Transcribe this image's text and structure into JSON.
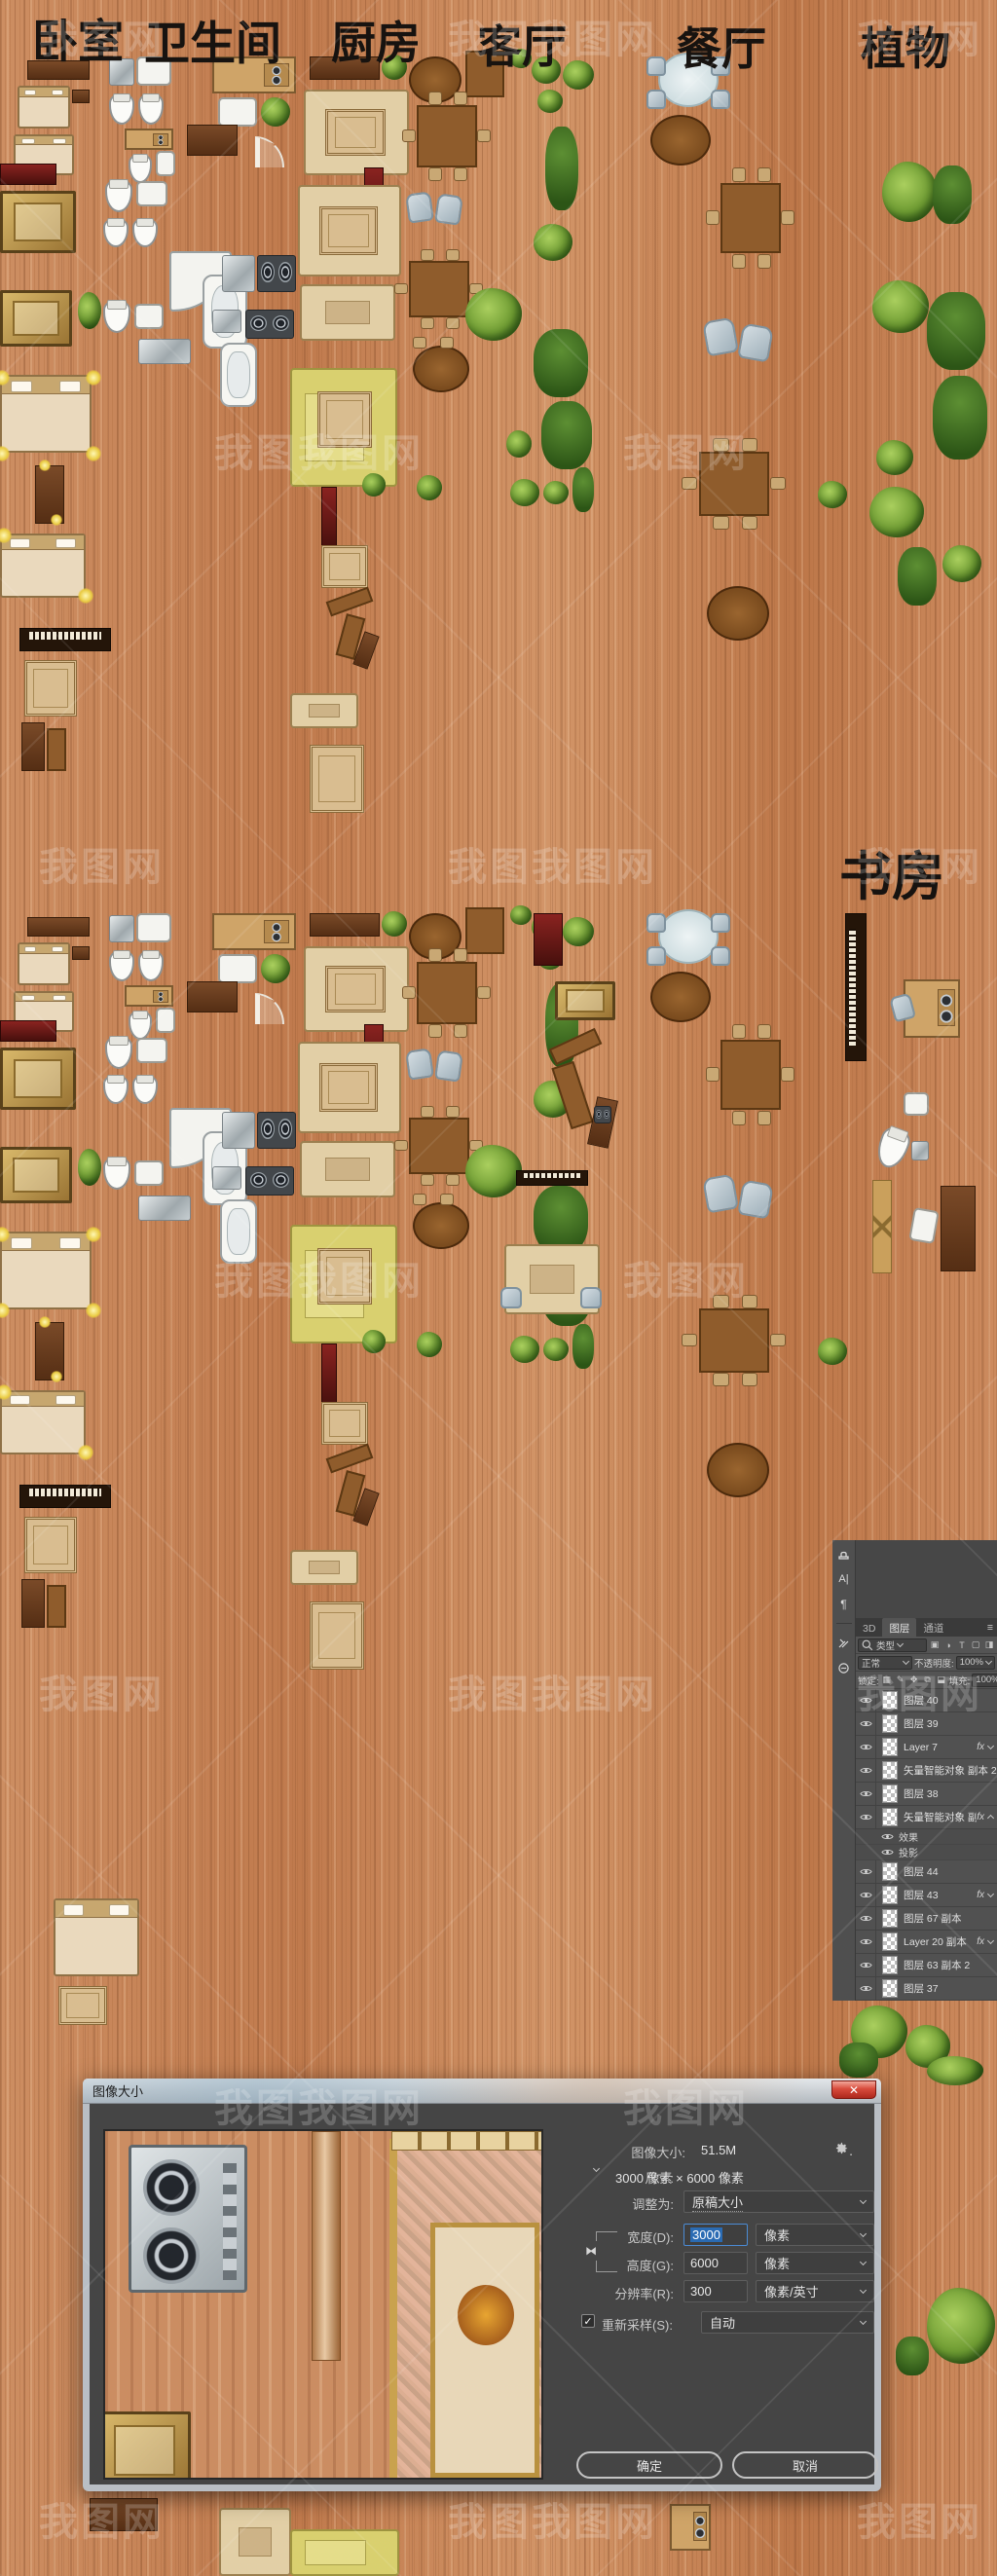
{
  "canvas": {
    "labels": {
      "bedroom": "卧室",
      "bathroom": "卫生间",
      "kitchen": "厨房",
      "living_room": "客厅",
      "dining_room": "餐厅",
      "plants": "植物",
      "study": "书房"
    }
  },
  "watermark": {
    "text_primary": "我图网",
    "text_secondary": "我图我图网"
  },
  "panel": {
    "tabs": [
      "3D",
      "图层",
      "通道"
    ],
    "active_tab": "图层",
    "filter_label": "类型",
    "blend_mode": "正常",
    "opacity_label": "不透明度:",
    "opacity_value": "100%",
    "lock_label": "锁定:",
    "fill_label": "填充:",
    "fill_value": "100%",
    "fx_label": "fx",
    "layers": [
      {
        "name": "图层 40"
      },
      {
        "name": "图层 39"
      },
      {
        "name": "Layer 7",
        "fx": true
      },
      {
        "name": "矢量智能对象 副本 2"
      },
      {
        "name": "图层 38"
      },
      {
        "name": "矢量智能对象 副本",
        "fx": true,
        "expanded": true,
        "effects": [
          "效果",
          "投影"
        ]
      },
      {
        "name": "图层 44"
      },
      {
        "name": "图层 43",
        "fx": true
      },
      {
        "name": "图层 67 副本"
      },
      {
        "name": "Layer 20 副本",
        "fx": true
      },
      {
        "name": "图层 63 副本 2"
      },
      {
        "name": "图层 37"
      }
    ]
  },
  "dialog": {
    "title": "图像大小",
    "close_glyph": "✕",
    "image_size_label": "图像大小:",
    "image_size_value": "51.5M",
    "dimensions_label": "尺寸:",
    "dimensions_value": "3000 像素  ×  6000 像素",
    "fit_to_label": "调整为:",
    "fit_to_value": "原稿大小",
    "width_label": "宽度(D):",
    "width_value": "3000",
    "width_unit": "像素",
    "height_label": "高度(G):",
    "height_value": "6000",
    "height_unit": "像素",
    "resolution_label": "分辨率(R):",
    "resolution_value": "300",
    "resolution_unit": "像素/英寸",
    "resample_label": "重新采样(S):",
    "resample_value": "自动",
    "resample_checked": "✓",
    "ok_label": "确定",
    "cancel_label": "取消"
  }
}
